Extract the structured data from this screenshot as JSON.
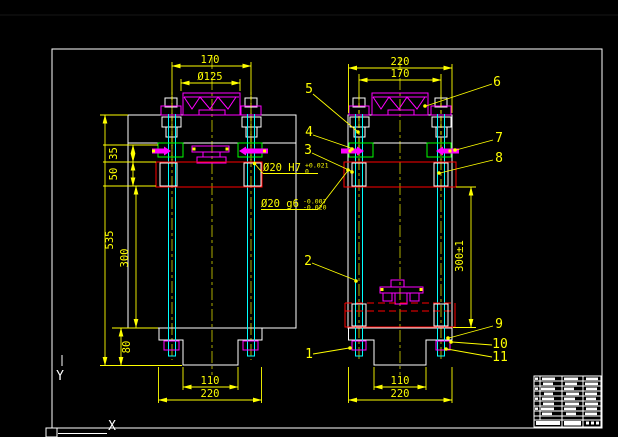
{
  "canvas": {
    "background": "#000000"
  },
  "palette": {
    "dimension": "#ffff00",
    "outline": "#ffffff",
    "part": "#ff00ff",
    "guide_post": "#00ffff",
    "die_holder": "#ff0000",
    "block": "#00ff00"
  },
  "left_view": {
    "top_width": "170",
    "shank_dia": "Ø125",
    "plate_thickness": "35",
    "holder_thickness": "50",
    "total_height": "535",
    "column_height": "300",
    "base_height": "80",
    "base_slot": "110",
    "base_width": "220"
  },
  "right_view": {
    "top_width": "220",
    "bolt_span": "170",
    "closed_height": "300±1",
    "base_slot": "110",
    "base_width": "220"
  },
  "callouts": {
    "bushing_fit": {
      "text": "Ø20 H7",
      "tol_upper": "+0.021",
      "tol_lower": "0"
    },
    "post_fit": {
      "text": "Ø20 g6",
      "tol_upper": "-0.007",
      "tol_lower": "-0.020"
    }
  },
  "balloons": {
    "b1": "1",
    "b2": "2",
    "b3": "3",
    "b4": "4",
    "b5": "5",
    "b6": "6",
    "b7": "7",
    "b8": "8",
    "b9": "9",
    "b10": "10",
    "b11": "11"
  },
  "ucs": {
    "x_label": "X",
    "y_label": "Y"
  }
}
